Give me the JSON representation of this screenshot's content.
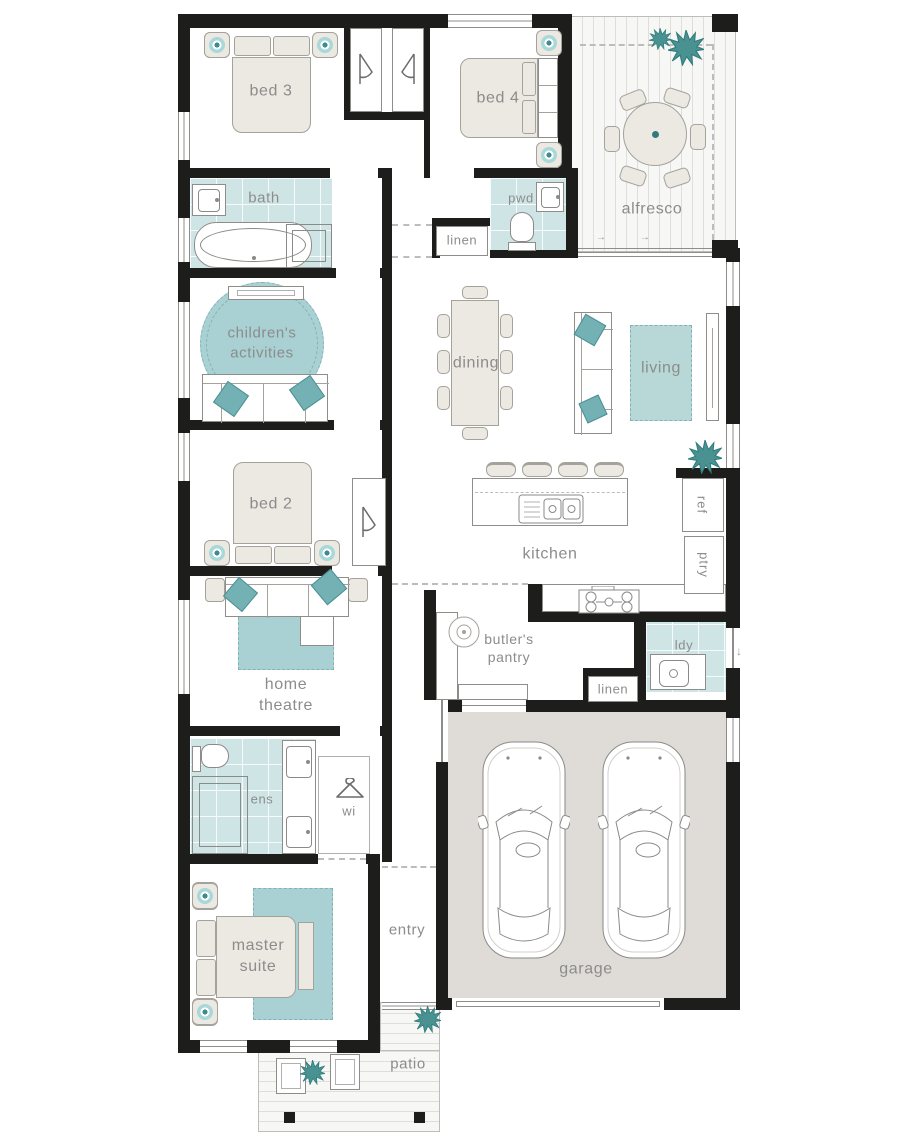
{
  "colors": {
    "wall": "#1d1d1b",
    "tile": "#cfe5e5",
    "rug": "#a9d0d2",
    "rug_living": "#b8d8d8",
    "accent": "#4a9191",
    "accent_dark": "#2f7c7c",
    "furniture": "#ece8e2",
    "furniture_outline": "#a5a29c",
    "garage_floor": "#dfdbd6",
    "label": "#8c8c8c"
  },
  "rooms": {
    "bed3": {
      "label": "bed 3"
    },
    "bed4": {
      "label": "bed 4"
    },
    "alfresco": {
      "label": "alfresco"
    },
    "bath": {
      "label": "bath"
    },
    "pwd": {
      "label": "pwd"
    },
    "linen_hall": {
      "label": "linen"
    },
    "childrens_activities": {
      "label": "children's\nactivities"
    },
    "dining": {
      "label": "dining"
    },
    "living": {
      "label": "living"
    },
    "kitchen": {
      "label": "kitchen"
    },
    "ref": {
      "label": "ref"
    },
    "ptry": {
      "label": "ptry"
    },
    "bed2": {
      "label": "bed 2"
    },
    "home_theatre": {
      "label": "home\ntheatre"
    },
    "butlers_pantry": {
      "label": "butler's\npantry"
    },
    "ldy": {
      "label": "ldy"
    },
    "linen_laundry": {
      "label": "linen"
    },
    "ens": {
      "label": "ens"
    },
    "wi": {
      "label": "wi"
    },
    "master_suite": {
      "label": "master\nsuite"
    },
    "entry": {
      "label": "entry"
    },
    "garage": {
      "label": "garage"
    },
    "patio": {
      "label": "patio"
    }
  }
}
